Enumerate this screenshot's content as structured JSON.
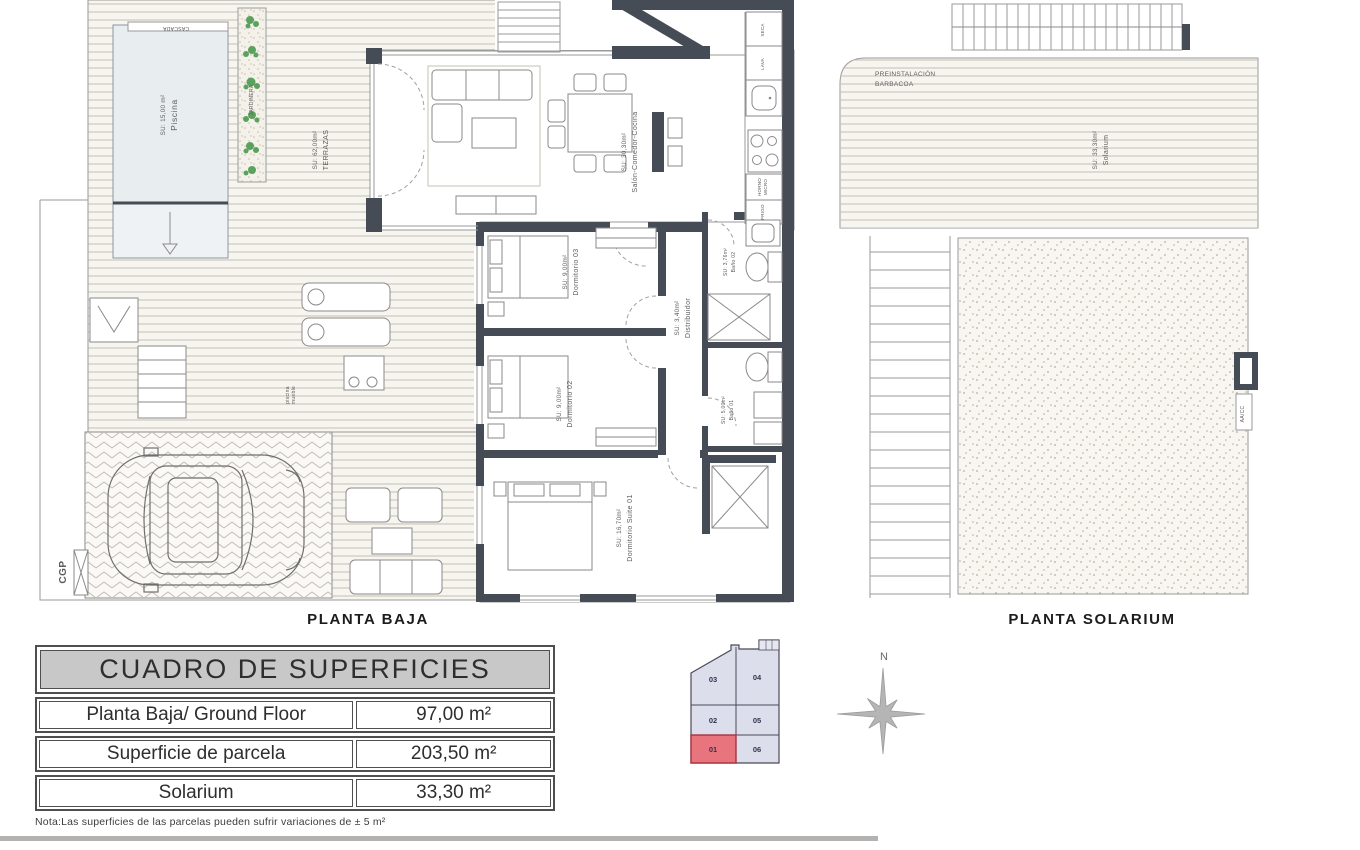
{
  "planta_baja": {
    "title": "PLANTA BAJA",
    "labels": {
      "cascada": "CASCADA",
      "piscina": "Piscina",
      "piscina_area": "SU: 15,00 m²",
      "jardinera": "JARDINERA",
      "terrazas": "TERRAZAS",
      "terrazas_area": "SU: 62,00m²",
      "salon": "Salón-Comedor-Cocina",
      "salon_area": "SU: 30,30m²",
      "dorm3": "Dormitorio 03",
      "dorm3_area": "SU: 9,00m²",
      "dorm2": "Dormitorio 02",
      "dorm2_area": "SU: 9,00m²",
      "suite": "Dormitorio Suite 01",
      "suite_area": "SU: 16,70m²",
      "distribuidor": "Distribuidor",
      "distribuidor_area": "SU: 3,40m²",
      "bano2": "Baño 02",
      "bano2_area": "SU: 3,76m²",
      "bano1": "Baño 01",
      "bano1_area": "SU: 5,00m²",
      "seca": "SECA",
      "lava": "LAVA",
      "horno": "HORNO",
      "micro": "MICRO",
      "frigo": "FRIGO",
      "mueble_line1": "mueble",
      "mueble_line2": "piscina",
      "aliviadero": "ALIVIADERO",
      "cgp": "CGP"
    }
  },
  "planta_solarium": {
    "title": "PLANTA SOLARIUM",
    "labels": {
      "preinstalacion": "PREINSTALACIÓN",
      "barbacoa": "BARBACOA",
      "solarium": "Solarium",
      "solarium_area": "SU: 33,30m²",
      "aacc": "AA/CC"
    }
  },
  "surface_table": {
    "title": "CUADRO DE SUPERFICIES",
    "rows": [
      {
        "label": "Planta Baja/ Ground Floor",
        "value": "97,00 m²"
      },
      {
        "label": "Superficie de parcela",
        "value": "203,50 m²"
      },
      {
        "label": "Solarium",
        "value": "33,30 m²"
      }
    ],
    "note": "Nota:Las superficies de las parcelas pueden sufrir variaciones de ± 5 m²"
  },
  "site_plan": {
    "plots": [
      {
        "id": "03"
      },
      {
        "id": "04"
      },
      {
        "id": "02"
      },
      {
        "id": "05"
      },
      {
        "id": "01"
      },
      {
        "id": "06"
      }
    ],
    "highlighted": "01",
    "highlight_color": "#e8747e"
  },
  "compass": {
    "north": "N"
  },
  "colors": {
    "wall": "#454c56",
    "plot_fill": "#dcdeec",
    "plot_highlight": "#e8747e",
    "red_text": "#c4404e"
  }
}
